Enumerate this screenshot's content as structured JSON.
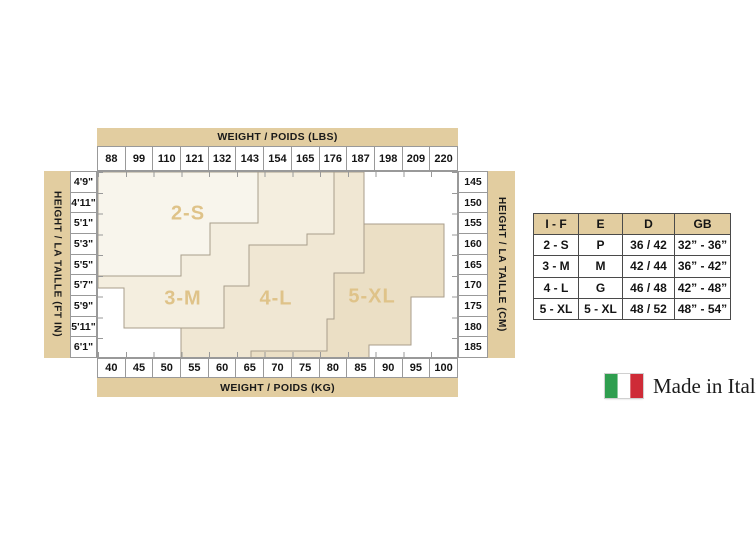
{
  "colors": {
    "tan_band": "#e2cda0",
    "grid_line": "#999999",
    "table_border": "#4a4a4a",
    "zone_label_text": "#dfc389",
    "text": "#141414"
  },
  "chart_data": {
    "type": "area",
    "description": "Hosiery size chart: stepped size zones plotted on a weight (x) by height (y) grid",
    "title_top": "WEIGHT / POIDS (LBS)",
    "title_bottom": "WEIGHT / POIDS (KG)",
    "axis_left_label": "HEIGHT / LA TAILLE (FT IN)",
    "axis_right_label": "HEIGHT / LA TAILLE (CM)",
    "x_axis": {
      "ticks_lbs": [
        "88",
        "99",
        "110",
        "121",
        "132",
        "143",
        "154",
        "165",
        "176",
        "187",
        "198",
        "209",
        "220"
      ],
      "ticks_kg": [
        "40",
        "45",
        "50",
        "55",
        "60",
        "65",
        "70",
        "75",
        "80",
        "85",
        "90",
        "95",
        "100"
      ]
    },
    "y_axis": {
      "ticks_ftin": [
        "4'9\"",
        "4'11\"",
        "5'1\"",
        "5'3\"",
        "5'5\"",
        "5'7\"",
        "5'9\"",
        "5'11\"",
        "6'1\""
      ],
      "ticks_cm": [
        "145",
        "150",
        "155",
        "160",
        "165",
        "170",
        "175",
        "180",
        "185"
      ]
    },
    "zones": [
      {
        "label": "2-S",
        "fill": "#f8f5ec",
        "approx_weight_lbs": "88-146",
        "approx_height_cm": "145-168",
        "points": "0,0 160,0 160,51 112,51 112,83 83,83 83,104 0,104"
      },
      {
        "label": "3-M",
        "fill": "#f4eedf",
        "approx_weight_lbs": "88-176",
        "approx_height_cm": "145-182",
        "points": "160,0 236,0 236,62 209,62 209,73 151,73 151,114 126,114 126,156 26,156 26,116 0,116 0,104 83,104 83,83 112,83 112,51 160,51"
      },
      {
        "label": "4-L",
        "fill": "#f0e7d3",
        "approx_weight_lbs": "110-198",
        "approx_height_cm": "145-185",
        "points": "236,0 266,0 266,101 236,101 236,147 229,147 229,179 153,179 153,187 83,187 83,156 126,156 126,114 151,114 151,73 209,73 209,62 236,62"
      },
      {
        "label": "5-XL",
        "fill": "#ebdfc5",
        "approx_weight_lbs": "148-220",
        "approx_height_cm": "155-185",
        "points": "266,52 346,52 346,125 313,125 313,173 271,173 271,187 153,187 153,179 229,179 229,147 236,147 236,101 266,101"
      }
    ],
    "zone_stroke": "#a89e8b"
  },
  "size_table": {
    "headers": [
      "I - F",
      "E",
      "D",
      "GB"
    ],
    "rows": [
      [
        "2 - S",
        "P",
        "36 / 42",
        "32” - 36”"
      ],
      [
        "3 - M",
        "M",
        "42 / 44",
        "36” - 42”"
      ],
      [
        "4 - L",
        "G",
        "46 / 48",
        "42” - 48”"
      ],
      [
        "5 - XL",
        "5 - XL",
        "48 / 52",
        "48” - 54”"
      ]
    ]
  },
  "footer": {
    "made_in": "Made in Italy",
    "flag_green": "#2f9e4f",
    "flag_white": "#ffffff",
    "flag_red": "#ce2b37"
  }
}
